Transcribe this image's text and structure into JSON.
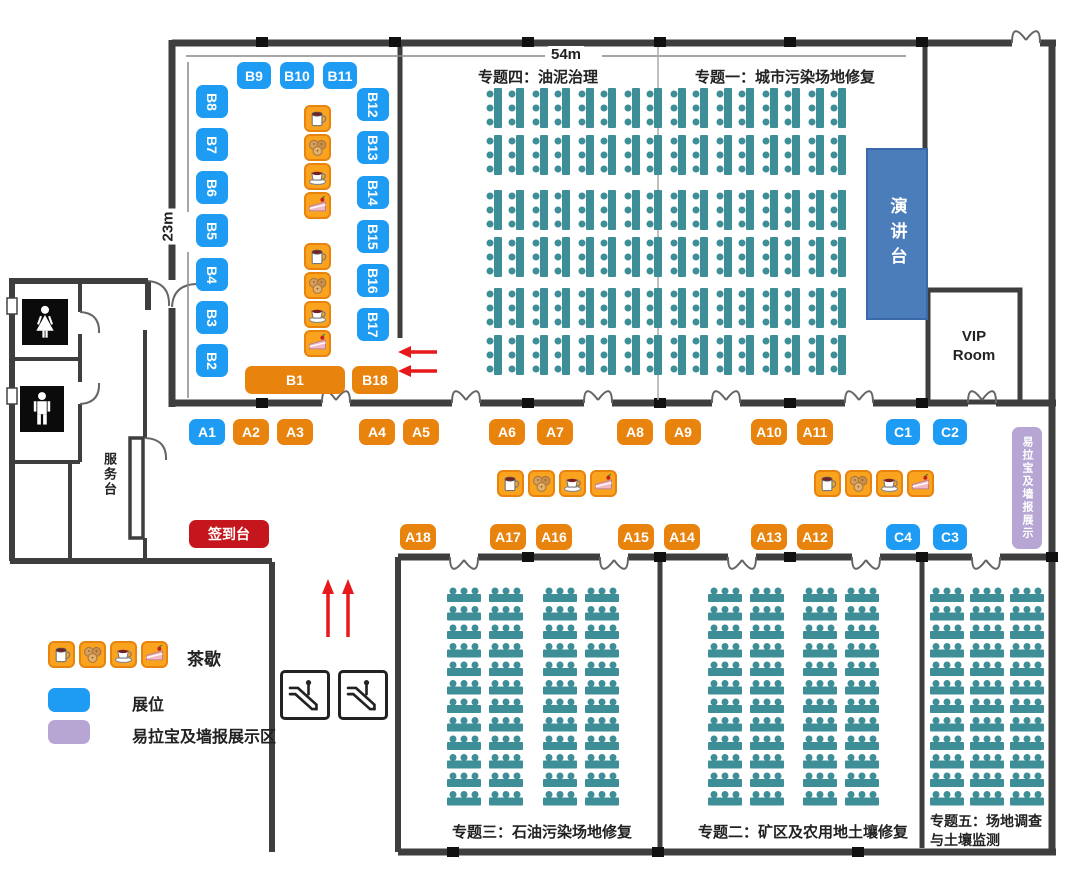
{
  "dimensions": {
    "width_label": "54m",
    "height_label": "23m"
  },
  "topics": {
    "t4": "专题四：油泥治理",
    "t1": "专题一：城市污染场地修复",
    "t3": "专题三：石油污染场地修复",
    "t2": "专题二：矿区及农用地土壤修复",
    "t5": "专题五：场地调查与土壤监测"
  },
  "rooms": {
    "podium": "演讲台",
    "vip_line1": "VIP",
    "vip_line2": "Room",
    "service_desk": "服务台",
    "banner_right": "易拉宝及墙报展示"
  },
  "legend": {
    "tea_label": "茶歇",
    "booth_label": "展位",
    "banner_label": "易拉宝及墙报展示区"
  },
  "colors": {
    "blue": "#1e9bf2",
    "orange": "#e8830d",
    "red": "#c4161c",
    "seat": "#3d8e97",
    "podium": "#4c7dbb",
    "purple": "#b7a6d4",
    "wall": "#3e3e3e",
    "arrow": "#e8191c",
    "icon_bg": "#f9a31f"
  },
  "tea_icons": [
    "mug",
    "puffs",
    "coffee",
    "cake"
  ],
  "tea_groups": [
    {
      "x": 304,
      "y": 105,
      "dir": "v"
    },
    {
      "x": 304,
      "y": 243,
      "dir": "v"
    },
    {
      "x": 497,
      "y": 470,
      "dir": "h"
    },
    {
      "x": 814,
      "y": 470,
      "dir": "h"
    },
    {
      "x": 48,
      "y": 641,
      "dir": "h"
    }
  ],
  "booths": [
    {
      "label": "B9",
      "type": "blue",
      "x": 237,
      "y": 62,
      "w": 34,
      "h": 27
    },
    {
      "label": "B10",
      "type": "blue",
      "x": 280,
      "y": 62,
      "w": 34,
      "h": 27
    },
    {
      "label": "B11",
      "type": "blue",
      "x": 323,
      "y": 62,
      "w": 34,
      "h": 27
    },
    {
      "label": "B8",
      "type": "blue",
      "x": 196,
      "y": 85,
      "w": 32,
      "h": 33,
      "rot": true
    },
    {
      "label": "B7",
      "type": "blue",
      "x": 196,
      "y": 128,
      "w": 32,
      "h": 33,
      "rot": true
    },
    {
      "label": "B6",
      "type": "blue",
      "x": 196,
      "y": 171,
      "w": 32,
      "h": 33,
      "rot": true
    },
    {
      "label": "B5",
      "type": "blue",
      "x": 196,
      "y": 214,
      "w": 32,
      "h": 33,
      "rot": true
    },
    {
      "label": "B4",
      "type": "blue",
      "x": 196,
      "y": 258,
      "w": 32,
      "h": 33,
      "rot": true
    },
    {
      "label": "B3",
      "type": "blue",
      "x": 196,
      "y": 301,
      "w": 32,
      "h": 33,
      "rot": true
    },
    {
      "label": "B2",
      "type": "blue",
      "x": 196,
      "y": 344,
      "w": 32,
      "h": 33,
      "rot": true
    },
    {
      "label": "B12",
      "type": "blue",
      "x": 357,
      "y": 88,
      "w": 32,
      "h": 33,
      "rot": true
    },
    {
      "label": "B13",
      "type": "blue",
      "x": 357,
      "y": 131,
      "w": 32,
      "h": 33,
      "rot": true
    },
    {
      "label": "B14",
      "type": "blue",
      "x": 357,
      "y": 176,
      "w": 32,
      "h": 33,
      "rot": true
    },
    {
      "label": "B15",
      "type": "blue",
      "x": 357,
      "y": 220,
      "w": 32,
      "h": 33,
      "rot": true
    },
    {
      "label": "B16",
      "type": "blue",
      "x": 357,
      "y": 264,
      "w": 32,
      "h": 33,
      "rot": true
    },
    {
      "label": "B17",
      "type": "blue",
      "x": 357,
      "y": 308,
      "w": 32,
      "h": 33,
      "rot": true
    },
    {
      "label": "B1",
      "type": "orange",
      "x": 245,
      "y": 366,
      "w": 100,
      "h": 28
    },
    {
      "label": "B18",
      "type": "orange",
      "x": 352,
      "y": 366,
      "w": 46,
      "h": 28
    },
    {
      "label": "A1",
      "type": "blue",
      "x": 189,
      "y": 419,
      "w": 36,
      "h": 26
    },
    {
      "label": "A2",
      "type": "orange",
      "x": 233,
      "y": 419,
      "w": 36,
      "h": 26
    },
    {
      "label": "A3",
      "type": "orange",
      "x": 277,
      "y": 419,
      "w": 36,
      "h": 26
    },
    {
      "label": "A4",
      "type": "orange",
      "x": 359,
      "y": 419,
      "w": 36,
      "h": 26
    },
    {
      "label": "A5",
      "type": "orange",
      "x": 403,
      "y": 419,
      "w": 36,
      "h": 26
    },
    {
      "label": "A6",
      "type": "orange",
      "x": 489,
      "y": 419,
      "w": 36,
      "h": 26
    },
    {
      "label": "A7",
      "type": "orange",
      "x": 537,
      "y": 419,
      "w": 36,
      "h": 26
    },
    {
      "label": "A8",
      "type": "orange",
      "x": 617,
      "y": 419,
      "w": 36,
      "h": 26
    },
    {
      "label": "A9",
      "type": "orange",
      "x": 665,
      "y": 419,
      "w": 36,
      "h": 26
    },
    {
      "label": "A10",
      "type": "orange",
      "x": 751,
      "y": 419,
      "w": 36,
      "h": 26
    },
    {
      "label": "A11",
      "type": "orange",
      "x": 797,
      "y": 419,
      "w": 36,
      "h": 26
    },
    {
      "label": "C1",
      "type": "blue",
      "x": 886,
      "y": 419,
      "w": 34,
      "h": 26
    },
    {
      "label": "C2",
      "type": "blue",
      "x": 933,
      "y": 419,
      "w": 34,
      "h": 26
    },
    {
      "label": "签到台",
      "type": "red",
      "x": 189,
      "y": 520,
      "w": 80,
      "h": 28
    },
    {
      "label": "A18",
      "type": "orange",
      "x": 400,
      "y": 524,
      "w": 36,
      "h": 26
    },
    {
      "label": "A17",
      "type": "orange",
      "x": 490,
      "y": 524,
      "w": 36,
      "h": 26
    },
    {
      "label": "A16",
      "type": "orange",
      "x": 536,
      "y": 524,
      "w": 36,
      "h": 26
    },
    {
      "label": "A15",
      "type": "orange",
      "x": 618,
      "y": 524,
      "w": 36,
      "h": 26
    },
    {
      "label": "A14",
      "type": "orange",
      "x": 664,
      "y": 524,
      "w": 36,
      "h": 26
    },
    {
      "label": "A13",
      "type": "orange",
      "x": 751,
      "y": 524,
      "w": 36,
      "h": 26
    },
    {
      "label": "A12",
      "type": "orange",
      "x": 797,
      "y": 524,
      "w": 36,
      "h": 26
    },
    {
      "label": "C4",
      "type": "blue",
      "x": 886,
      "y": 524,
      "w": 34,
      "h": 26
    },
    {
      "label": "C3",
      "type": "blue",
      "x": 933,
      "y": 524,
      "w": 34,
      "h": 26
    }
  ],
  "seating": {
    "top_hall": {
      "bands": 3,
      "rows_per_band": 2,
      "pairs_per_row": 8,
      "units_per_pair": 2,
      "chairs_per_unit": 3
    },
    "hall_t3": {
      "cols": 4,
      "rows": 12,
      "chairs_per_unit": 3
    },
    "hall_t2": {
      "cols": 4,
      "rows": 12,
      "chairs_per_unit": 3
    },
    "hall_t5": {
      "cols": 3,
      "rows": 12,
      "chairs_per_unit": 3
    }
  },
  "icons": {
    "toilets": [
      "women-toilet-icon",
      "men-toilet-icon"
    ],
    "escalator_count": 2
  }
}
